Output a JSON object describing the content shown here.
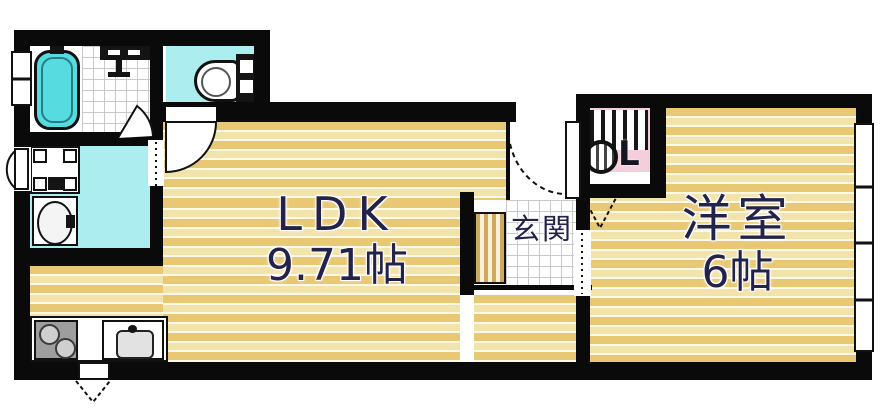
{
  "plan_type": "japanese-apartment-floor-plan",
  "rooms": {
    "ldk": {
      "name": "LDK",
      "size": "9.71帖"
    },
    "western_room": {
      "name": "洋室",
      "size": "6帖"
    },
    "entrance": {
      "name": "玄関"
    },
    "closet": {
      "label": "CL",
      "label_letter": "L"
    }
  },
  "fixtures": [
    "bathtub",
    "shower-room",
    "toilet",
    "washing-machine-pan",
    "washbasin",
    "kitchen-stove",
    "kitchen-sink",
    "shoe-cabinet",
    "entry-door",
    "east-window",
    "west-window",
    "closet-hanger-pipe"
  ],
  "colors": {
    "wall": "#0a0a0a",
    "flooring_stripe_dark": "#e8c873",
    "flooring_stripe_light": "#f2e3ab",
    "wet_area_floor": "#aceef0",
    "bathtub_fill": "#55dbe0",
    "closet_floor": "#f4cedc",
    "label_text": "#23234a"
  }
}
